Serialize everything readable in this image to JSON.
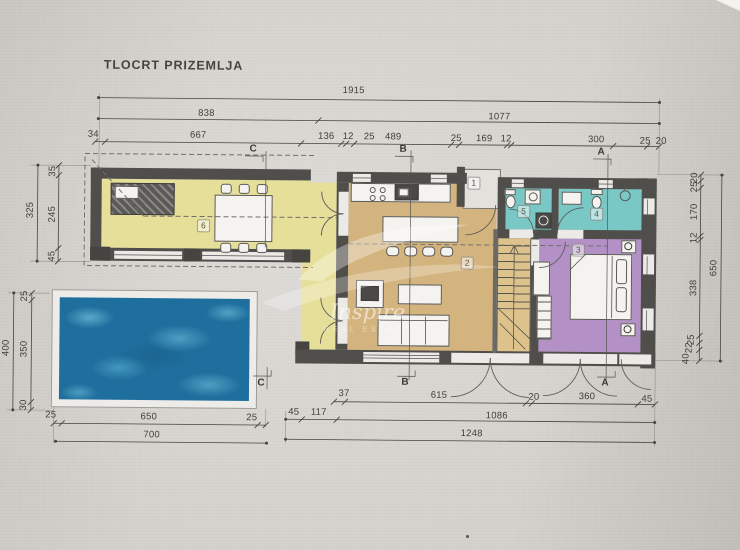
{
  "title": "TLOCRT PRIZEMLJA",
  "rooms": {
    "r1": "1",
    "r2": "2",
    "r3": "3",
    "r4": "4",
    "r5": "5",
    "r6": "6"
  },
  "sections": {
    "a": "A",
    "b": "B",
    "c": "C"
  },
  "watermark": {
    "script": "Inspire",
    "caps": "REAL ESTATE"
  },
  "dims": {
    "top1": [
      "1915"
    ],
    "top2": [
      "838",
      "1077"
    ],
    "top3": [
      "34",
      "667",
      "136",
      "12",
      "25",
      "489",
      "25",
      "169",
      "12",
      "300",
      "25",
      "20"
    ],
    "right_inner": [
      "20",
      "25",
      "170",
      "12",
      "338",
      "25",
      "22",
      "40"
    ],
    "right_outer": [
      "650"
    ],
    "left_wing_inner": [
      "35",
      "245",
      "45"
    ],
    "left_wing_outer": [
      "325"
    ],
    "left_pool_inner": [
      "25",
      "350",
      "30"
    ],
    "left_pool_outer": [
      "400"
    ],
    "house_bottom1": [
      "37",
      "615",
      "20",
      "360",
      "45"
    ],
    "house_bottom2": [
      "45",
      "117",
      "1086"
    ],
    "house_bottom3": [
      "1248"
    ],
    "pool_bottom1": [
      "25",
      "650",
      "25"
    ],
    "pool_bottom2": [
      "700"
    ]
  },
  "colors": {
    "wall": "#504e4a",
    "terrace-yellow": "#e6df9a",
    "living-tan": "#d4b47e",
    "bath-cyan": "#79c8c6",
    "bedroom-purple": "#b391c7",
    "stairs": "#ddc28c",
    "pool": "#1f6f9e",
    "paper": "#d6d3ce"
  }
}
